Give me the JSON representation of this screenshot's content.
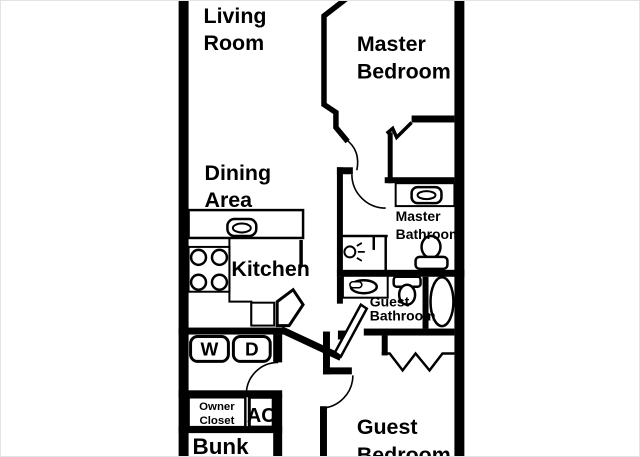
{
  "colors": {
    "wall": "#000000",
    "floor": "#ffffff"
  },
  "rooms": {
    "living_room": {
      "line1": "Living",
      "line2": "Room"
    },
    "master_bedroom": {
      "line1": "Master",
      "line2": "Bedroom"
    },
    "dining_area": {
      "line1": "Dining",
      "line2": "Area"
    },
    "kitchen": {
      "line1": "Kitchen"
    },
    "master_bathroom": {
      "line1": "Master",
      "line2": "Bathroom"
    },
    "guest_bathroom": {
      "line1": "Guest",
      "line2": "Bathroom"
    },
    "guest_bedroom": {
      "line1": "Guest",
      "line2": "Bedroom"
    },
    "bunk": {
      "line1": "Bunk"
    },
    "owner_closet": {
      "line1": "Owner",
      "line2": "Closet"
    },
    "ac": {
      "line1": "AC"
    }
  },
  "appliances": {
    "washer": "W",
    "dryer": "D"
  },
  "fixtures": [
    "kitchen-sink",
    "stove-burners",
    "washer",
    "dryer",
    "master-bath-sink",
    "master-bath-toilet",
    "shower-light",
    "guest-bath-sink",
    "guest-bath-toilet",
    "bathtub",
    "bifold-closet-doors"
  ]
}
